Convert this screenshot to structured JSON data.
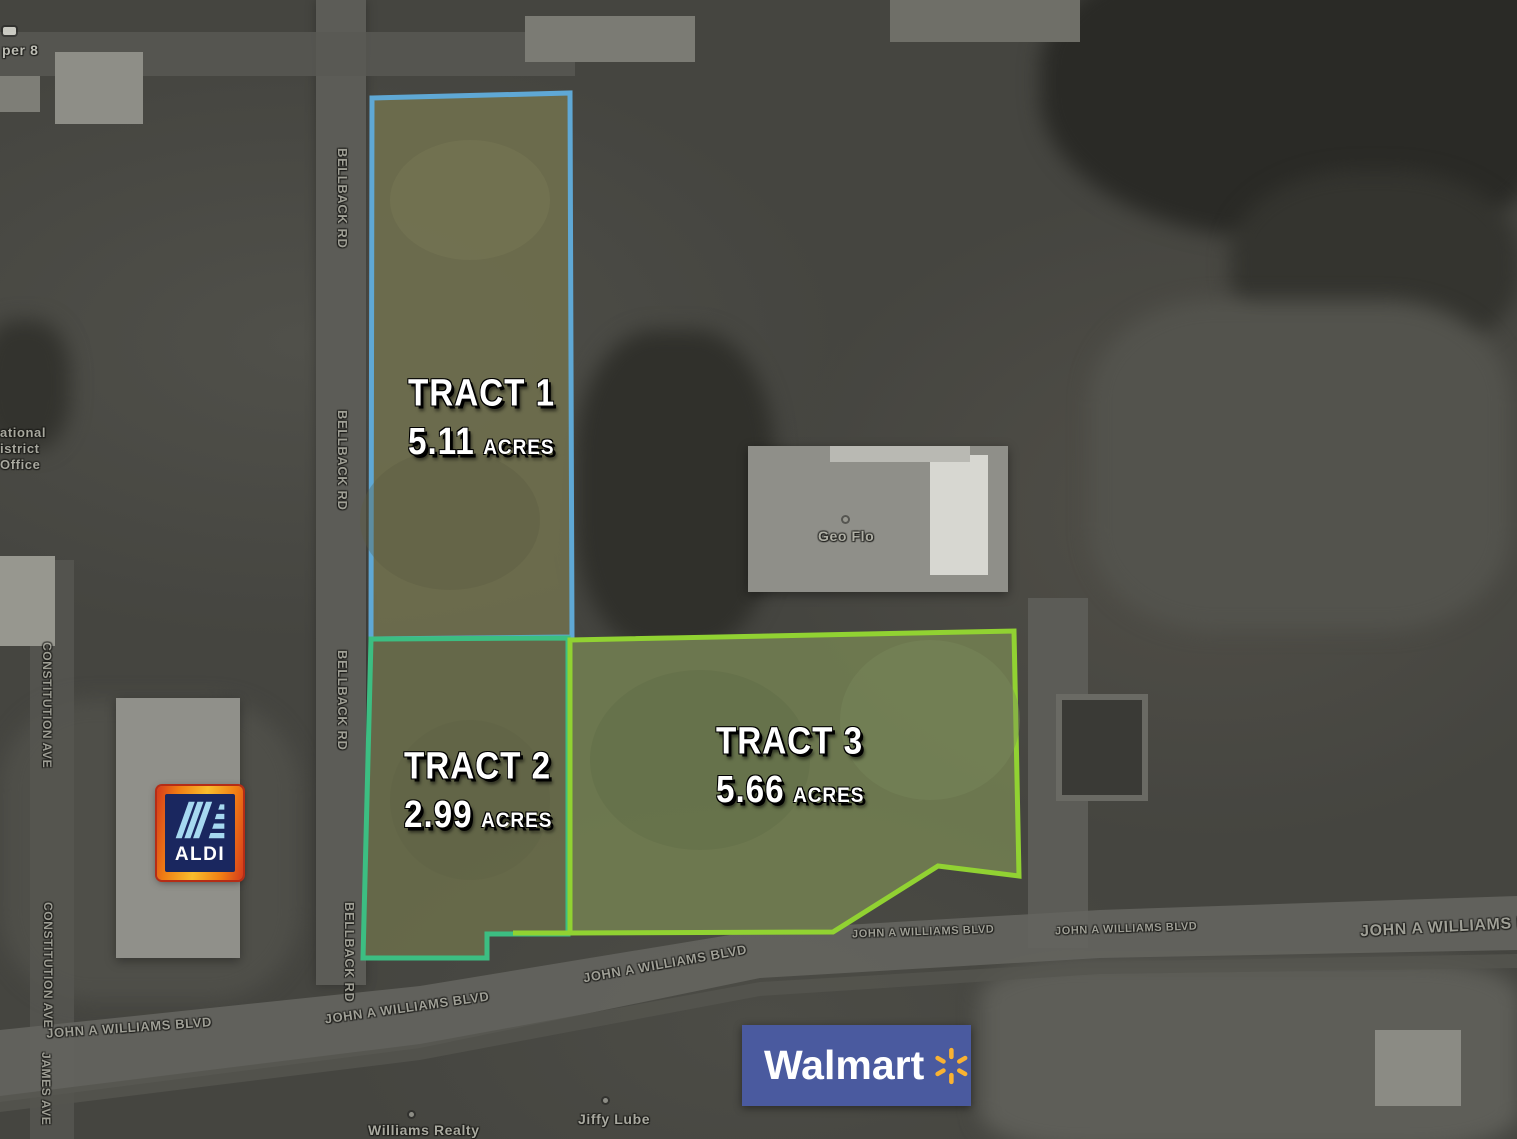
{
  "tracts": [
    {
      "name": "TRACT 1",
      "acres": "5.11",
      "unit": "ACRES"
    },
    {
      "name": "TRACT 2",
      "acres": "2.99",
      "unit": "ACRES"
    },
    {
      "name": "TRACT 3",
      "acres": "5.66",
      "unit": "ACRES"
    }
  ],
  "roads": {
    "bellback": "BELLBACK RD",
    "constitution": "CONSTITUTION AVE",
    "james": "JAMES AVE",
    "john_a_williams": "JOHN A WILLIAMS BLVD"
  },
  "places": {
    "super8_partial": "per 8",
    "office_line1": "ational",
    "office_line2": "istrict",
    "office_line3": "Office",
    "geo_flo": "Geo Flo",
    "williams_realty": "Williams Realty",
    "jiffy_lube": "Jiffy Lube"
  },
  "logos": {
    "aldi": {
      "text": "ALDI"
    },
    "walmart": {
      "text": "Walmart"
    }
  },
  "colors": {
    "tract1_outline": "#5fa8d5",
    "tract2_outline": "#3cbe82",
    "tract3_outline": "#91d232",
    "walmart_blue": "#4a5a9f",
    "walmart_spark": "#f9b232",
    "aldi_navy": "#1a275f",
    "aldi_lightblue": "#a6d9f0"
  }
}
